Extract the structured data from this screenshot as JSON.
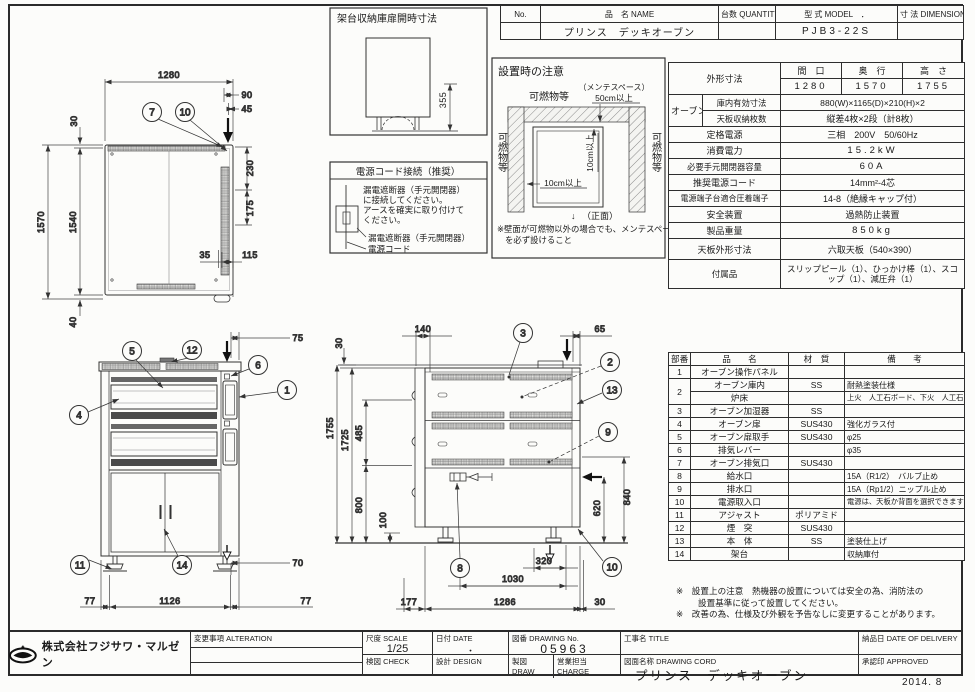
{
  "header": {
    "no_label": "No.",
    "name_label": "品　名 NAME",
    "qty_label": "台数 QUANTITY",
    "model_label": "型 式 MODEL　．",
    "dim_label": "寸 法 DIMENSION",
    "name_value": "プリンス　デッキオーブン",
    "model_value": "PJB3-22S"
  },
  "spec": {
    "outer_label": "外形寸法",
    "w_label": "間　口",
    "d_label": "奥　行",
    "h_label": "高　さ",
    "w_value": "1280",
    "d_value": "1570",
    "h_value": "1755",
    "oven_label": "オーブン",
    "inner_label": "庫内有効寸法",
    "inner_value": "880(W)×1165(D)×210(H)×2",
    "tray_label": "天板収納枚数",
    "tray_value": "縦差4枚×2段（計8枚）",
    "rows": [
      {
        "label": "定格電源",
        "value": "三相　200V　50/60Hz"
      },
      {
        "label": "消費電力",
        "value": "15.2kW"
      },
      {
        "label": "必要手元開閉器容量",
        "value": "60A"
      },
      {
        "label": "推奨電源コード",
        "value": "14mm²-4芯"
      },
      {
        "label": "電源端子台適合圧着端子",
        "value": "14-8（絶縁キャップ付）"
      },
      {
        "label": "安全装置",
        "value": "過熱防止装置"
      },
      {
        "label": "製品重量",
        "value": "850kg"
      },
      {
        "label": "天板外形寸法",
        "value": "六取天板（540×390）"
      },
      {
        "label": "付属品",
        "value": "スリップピール（1）、ひっかけ棒（1）、スコップ（1）、減圧弁（1）"
      }
    ]
  },
  "parts": {
    "h_no": "部番",
    "h_name": "品　　名",
    "h_mat": "材　質",
    "h_note": "備　　考",
    "rows": [
      {
        "no": "1",
        "name": "オーブン操作パネル",
        "mat": "",
        "note": ""
      },
      {
        "no": "2",
        "name": "オーブン庫内",
        "mat": "SS",
        "note": "耐熱塗装仕様"
      },
      {
        "no": "",
        "name": "炉床",
        "mat": "",
        "note": "上火　人工石ボード、下火　人工石ボード"
      },
      {
        "no": "3",
        "name": "オーブン加湿器",
        "mat": "SS",
        "note": ""
      },
      {
        "no": "4",
        "name": "オーブン扉",
        "mat": "SUS430",
        "note": "強化ガラス付"
      },
      {
        "no": "5",
        "name": "オーブン扉取手",
        "mat": "SUS430",
        "note": "φ25"
      },
      {
        "no": "6",
        "name": "排気レバー",
        "mat": "",
        "note": "φ35"
      },
      {
        "no": "7",
        "name": "オーブン排気口",
        "mat": "SUS430",
        "note": ""
      },
      {
        "no": "8",
        "name": "給水口",
        "mat": "",
        "note": "15A（R1/2）　バルブ止め"
      },
      {
        "no": "9",
        "name": "排水口",
        "mat": "",
        "note": "15A（Rp1/2）ニップル止め"
      },
      {
        "no": "10",
        "name": "電源取入口",
        "mat": "",
        "note": "電源は、天板か背面を選択できます"
      },
      {
        "no": "11",
        "name": "アジャスト",
        "mat": "ポリアミド",
        "note": ""
      },
      {
        "no": "12",
        "name": "煙　突",
        "mat": "SUS430",
        "note": ""
      },
      {
        "no": "13",
        "name": "本　体",
        "mat": "SS",
        "note": "塗装仕上げ"
      },
      {
        "no": "14",
        "name": "架台",
        "mat": "",
        "note": "収納庫付"
      }
    ]
  },
  "notes": {
    "l1": "※　設置上の注意　熱機器の設置については安全の為、消防法の",
    "l2": "設置基準に従って設置してください。",
    "l3": "※　改善の為、仕様及び外観を予告なしに変更することがあります。"
  },
  "tb": {
    "company": "株式会社フジサワ・マルゼン",
    "alteration": "変更事項  ALTERATION",
    "scale_label": "尺度  SCALE",
    "scale_value": "1/25",
    "date_label": "日付  DATE",
    "date_value": "・",
    "check_label": "検図  CHECK",
    "design_label": "設計  DESIGN",
    "drawno_label": "図番  DRAWING No.",
    "drawno_value": "05963",
    "draw_label": "製図  DRAW",
    "charge_label": "営業担当 CHARGE",
    "title_label": "工事名  TITLE",
    "name_label": "図面名称  DRAWING CORD",
    "name_value": "プリンス　デッキオーブン",
    "delivery_label": "納品日  DATE OF DELIVERY",
    "approved_label": "承認印  APPROVED",
    "date_stamp": "2014. 8"
  },
  "plan": {
    "d1280": "1280",
    "d90": "90",
    "d45": "45",
    "d30": "30",
    "d1570": "1570",
    "d1540": "1540",
    "d40": "40",
    "d230": "230",
    "d175": "175",
    "d35": "35",
    "d115": "115",
    "c7": "7",
    "c10": "10"
  },
  "front": {
    "d75": "75",
    "d70": "70",
    "d77a": "77",
    "d1126": "1126",
    "d77b": "77",
    "c5": "5",
    "c12": "12",
    "c6": "6",
    "c1": "1",
    "c4": "4",
    "c11": "11",
    "c14": "14"
  },
  "rear": {
    "d140": "140",
    "d65": "65",
    "d30a": "30",
    "d1755": "1755",
    "d1725": "1725",
    "d485": "485",
    "d800": "800",
    "d100": "100",
    "d840": "840",
    "d620": "620",
    "d320": "320",
    "d1030": "1030",
    "d177": "177",
    "d1286": "1286",
    "d30b": "30",
    "c3": "3",
    "c2": "2",
    "c13": "13",
    "c9": "9",
    "c8": "8",
    "c10": "10"
  },
  "boxA": {
    "title": "架台収納庫扉開時寸法",
    "d355": "355"
  },
  "boxB": {
    "title": "電源コード接続（推奨）",
    "l1": "漏電遮断器（手元開閉器）",
    "l2": "に接続してください。",
    "l3": "アースを確実に取り付けて",
    "l4": "ください。",
    "lbl1": "漏電遮断器（手元開閉器）",
    "lbl2": "電源コード"
  },
  "boxC": {
    "title": "設置時の注意",
    "fuel_top": "可燃物等",
    "fuel_left": "可燃物等",
    "fuel_right": "可燃物等",
    "maint": "（メンテスペース）",
    "d50": "50cm以上",
    "d10v": "10cm以上",
    "d10h": "10cm以上",
    "front_mark": "↓",
    "front_label": "（正面）",
    "n1": "※壁面が可燃物以外の場合でも、メンテスペース",
    "n2": "を必ず設けること"
  }
}
